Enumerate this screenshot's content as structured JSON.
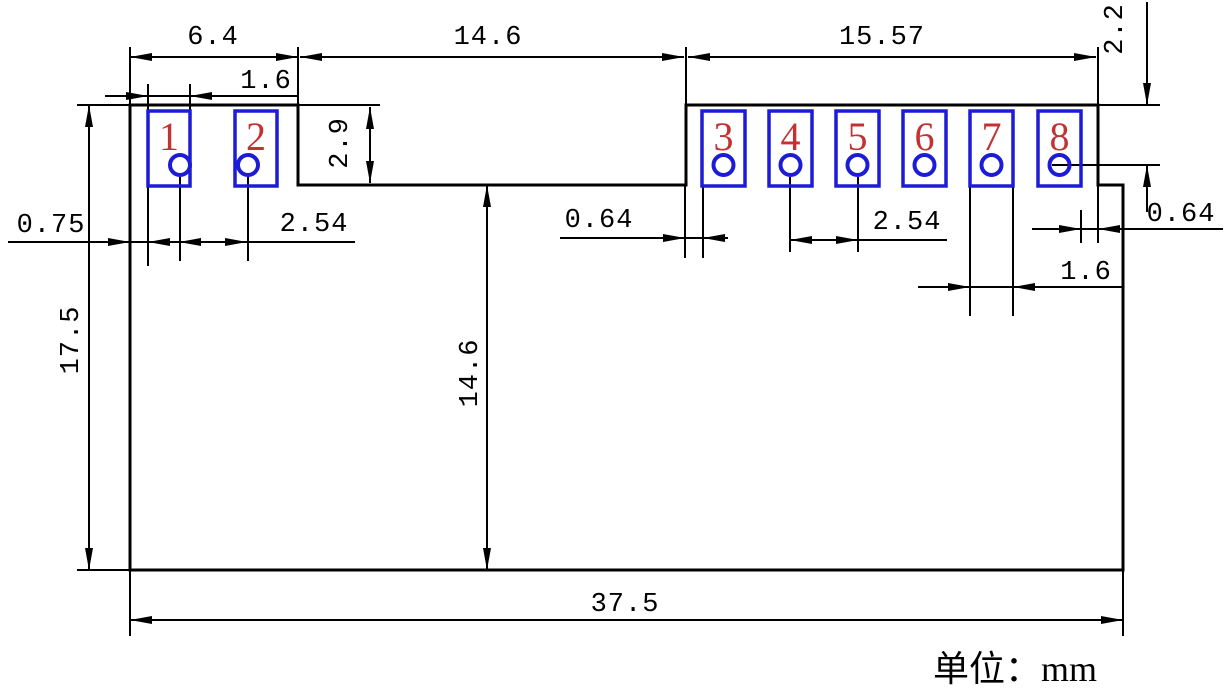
{
  "unit_note": "单位：mm",
  "pads": [
    {
      "number": "1"
    },
    {
      "number": "2"
    },
    {
      "number": "3"
    },
    {
      "number": "4"
    },
    {
      "number": "5"
    },
    {
      "number": "6"
    },
    {
      "number": "7"
    },
    {
      "number": "8"
    }
  ],
  "dimensions": {
    "top_left_section_width": "6.4",
    "notch_width": "14.6",
    "top_right_section_width": "15.57",
    "pad_width_left": "1.6",
    "notch_depth": "2.9",
    "edge_to_pad1_gap": "0.75",
    "hole_pitch_left": "2.54",
    "notch_to_pad3_gap": "0.64",
    "hole_pitch_right": "2.54",
    "top_to_hole_row": "2.2",
    "pad8_to_edge_gap": "0.64",
    "pad7_width": "1.6",
    "total_height": "17.5",
    "notch_to_bottom": "14.6",
    "total_width": "37.5"
  },
  "colors": {
    "line": "#000000",
    "pad_outline": "#1c1cd6",
    "pin_number": "#c23232",
    "background": "#ffffff"
  }
}
